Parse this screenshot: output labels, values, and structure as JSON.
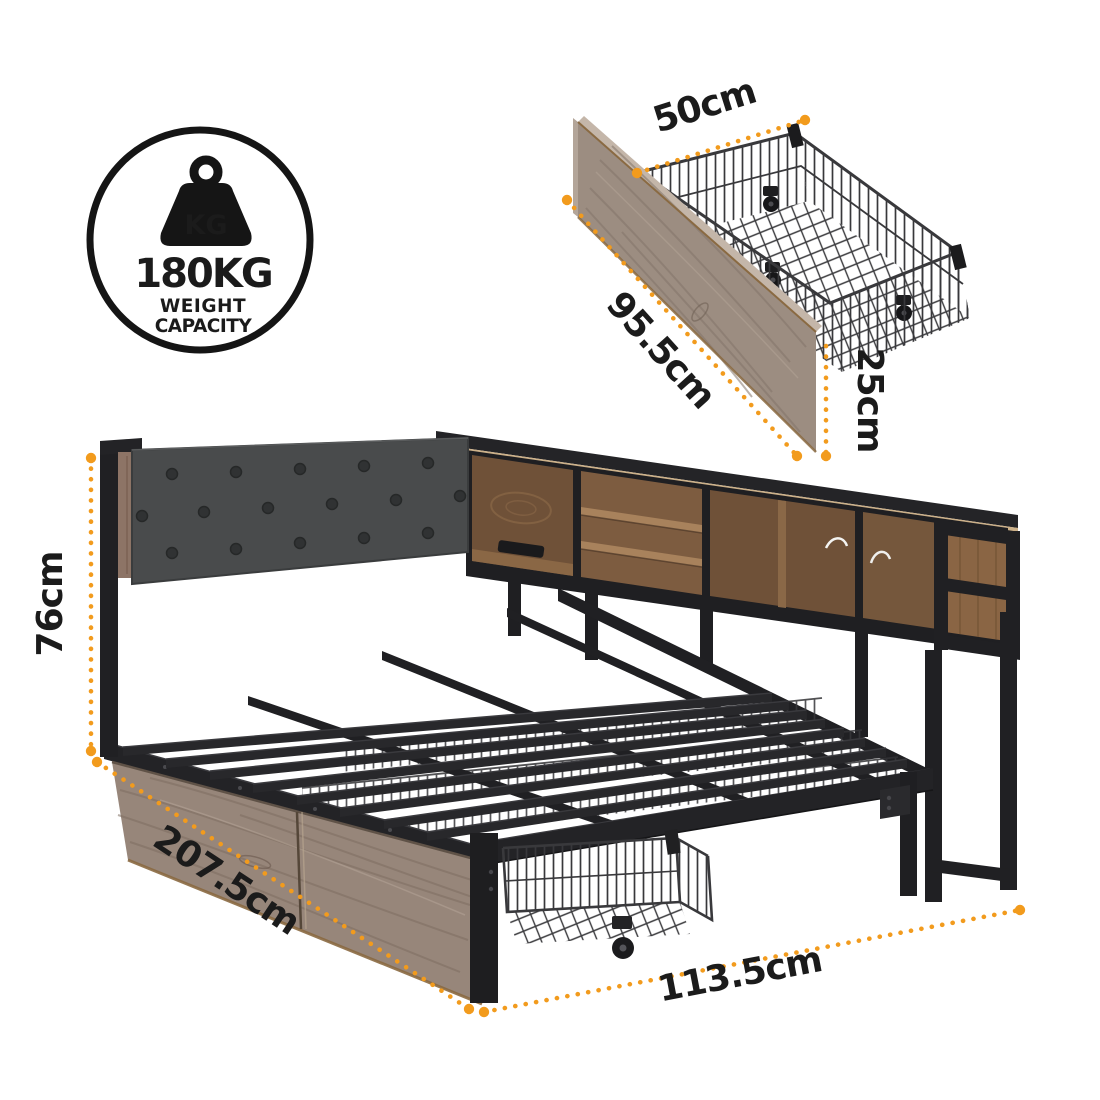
{
  "badge": {
    "icon": "weight-kettlebell-icon",
    "icon_label": "KG",
    "value": "180KG",
    "caption_line1": "WEIGHT",
    "caption_line2": "CAPACITY"
  },
  "drawer_detail": {
    "description": "under-bed wire storage drawer with wood front and castors",
    "width_label": "50cm",
    "depth_label": "95.5cm",
    "height_label": "25cm"
  },
  "bed": {
    "description": "bed frame with tufted headboard, side bookshelf, metal slats, wood drawer fronts and roll-out wire drawer",
    "height_label": "76cm",
    "length_label": "207.5cm",
    "width_label": "113.5cm"
  },
  "colors": {
    "accent_orange": "#F29B1D",
    "label_text": "#1B1B1B",
    "metal_black": "#232326",
    "fabric_gray": "#494B4C",
    "wood_taupe": "#97867A",
    "wood_brown": "#7D5C40",
    "wood_light_edge": "#CDB189"
  }
}
